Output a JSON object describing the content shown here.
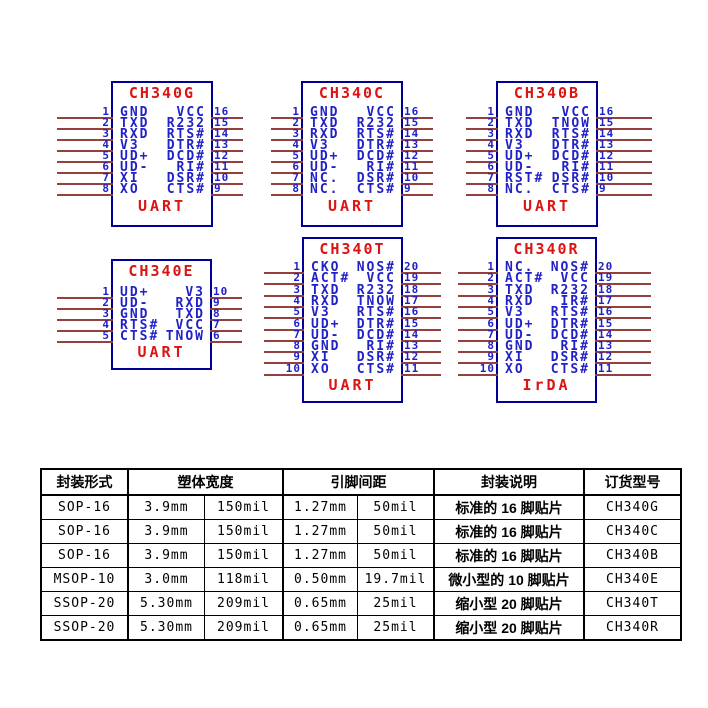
{
  "chips": [
    {
      "title": "CH340G",
      "function_label": "UART",
      "left_pins": [
        {
          "num": "1",
          "label": "GND"
        },
        {
          "num": "2",
          "label": "TXD"
        },
        {
          "num": "3",
          "label": "RXD"
        },
        {
          "num": "4",
          "label": "V3"
        },
        {
          "num": "5",
          "label": "UD+"
        },
        {
          "num": "6",
          "label": "UD-"
        },
        {
          "num": "7",
          "label": "XI"
        },
        {
          "num": "8",
          "label": "XO"
        }
      ],
      "right_pins": [
        {
          "num": "16",
          "label": "VCC"
        },
        {
          "num": "15",
          "label": "R232"
        },
        {
          "num": "14",
          "label": "RTS#"
        },
        {
          "num": "13",
          "label": "DTR#"
        },
        {
          "num": "12",
          "label": "DCD#"
        },
        {
          "num": "11",
          "label": "RI#"
        },
        {
          "num": "10",
          "label": "DSR#"
        },
        {
          "num": "9",
          "label": "CTS#"
        }
      ]
    },
    {
      "title": "CH340C",
      "function_label": "UART",
      "left_pins": [
        {
          "num": "1",
          "label": "GND"
        },
        {
          "num": "2",
          "label": "TXD"
        },
        {
          "num": "3",
          "label": "RXD"
        },
        {
          "num": "4",
          "label": "V3"
        },
        {
          "num": "5",
          "label": "UD+"
        },
        {
          "num": "6",
          "label": "UD-"
        },
        {
          "num": "7",
          "label": "NC."
        },
        {
          "num": "8",
          "label": "NC."
        }
      ],
      "right_pins": [
        {
          "num": "16",
          "label": "VCC"
        },
        {
          "num": "15",
          "label": "R232"
        },
        {
          "num": "14",
          "label": "RTS#"
        },
        {
          "num": "13",
          "label": "DTR#"
        },
        {
          "num": "12",
          "label": "DCD#"
        },
        {
          "num": "11",
          "label": "RI#"
        },
        {
          "num": "10",
          "label": "DSR#"
        },
        {
          "num": "9",
          "label": "CTS#"
        }
      ]
    },
    {
      "title": "CH340B",
      "function_label": "UART",
      "left_pins": [
        {
          "num": "1",
          "label": "GND"
        },
        {
          "num": "2",
          "label": "TXD"
        },
        {
          "num": "3",
          "label": "RXD"
        },
        {
          "num": "4",
          "label": "V3"
        },
        {
          "num": "5",
          "label": "UD+"
        },
        {
          "num": "6",
          "label": "UD-"
        },
        {
          "num": "7",
          "label": "RST#"
        },
        {
          "num": "8",
          "label": "NC."
        }
      ],
      "right_pins": [
        {
          "num": "16",
          "label": "VCC"
        },
        {
          "num": "15",
          "label": "TNOW"
        },
        {
          "num": "14",
          "label": "RTS#"
        },
        {
          "num": "13",
          "label": "DTR#"
        },
        {
          "num": "12",
          "label": "DCD#"
        },
        {
          "num": "11",
          "label": "RI#"
        },
        {
          "num": "10",
          "label": "DSR#"
        },
        {
          "num": "9",
          "label": "CTS#"
        }
      ]
    },
    {
      "title": "CH340E",
      "function_label": "UART",
      "left_pins": [
        {
          "num": "1",
          "label": "UD+"
        },
        {
          "num": "2",
          "label": "UD-"
        },
        {
          "num": "3",
          "label": "GND"
        },
        {
          "num": "4",
          "label": "RTS#"
        },
        {
          "num": "5",
          "label": "CTS#"
        }
      ],
      "right_pins": [
        {
          "num": "10",
          "label": "V3"
        },
        {
          "num": "9",
          "label": "RXD"
        },
        {
          "num": "8",
          "label": "TXD"
        },
        {
          "num": "7",
          "label": "VCC"
        },
        {
          "num": "6",
          "label": "TNOW"
        }
      ]
    },
    {
      "title": "CH340T",
      "function_label": "UART",
      "left_pins": [
        {
          "num": "1",
          "label": "CKO"
        },
        {
          "num": "2",
          "label": "ACT#"
        },
        {
          "num": "3",
          "label": "TXD"
        },
        {
          "num": "4",
          "label": "RXD"
        },
        {
          "num": "5",
          "label": "V3"
        },
        {
          "num": "6",
          "label": "UD+"
        },
        {
          "num": "7",
          "label": "UD-"
        },
        {
          "num": "8",
          "label": "GND"
        },
        {
          "num": "9",
          "label": "XI"
        },
        {
          "num": "10",
          "label": "XO"
        }
      ],
      "right_pins": [
        {
          "num": "20",
          "label": "NOS#"
        },
        {
          "num": "19",
          "label": "VCC"
        },
        {
          "num": "18",
          "label": "R232"
        },
        {
          "num": "17",
          "label": "TNOW"
        },
        {
          "num": "16",
          "label": "RTS#"
        },
        {
          "num": "15",
          "label": "DTR#"
        },
        {
          "num": "14",
          "label": "DCD#"
        },
        {
          "num": "13",
          "label": "RI#"
        },
        {
          "num": "12",
          "label": "DSR#"
        },
        {
          "num": "11",
          "label": "CTS#"
        }
      ]
    },
    {
      "title": "CH340R",
      "function_label": "IrDA",
      "left_pins": [
        {
          "num": "1",
          "label": "NC."
        },
        {
          "num": "2",
          "label": "ACT#"
        },
        {
          "num": "3",
          "label": "TXD"
        },
        {
          "num": "4",
          "label": "RXD"
        },
        {
          "num": "5",
          "label": "V3"
        },
        {
          "num": "6",
          "label": "UD+"
        },
        {
          "num": "7",
          "label": "UD-"
        },
        {
          "num": "8",
          "label": "GND"
        },
        {
          "num": "9",
          "label": "XI"
        },
        {
          "num": "10",
          "label": "XO"
        }
      ],
      "right_pins": [
        {
          "num": "20",
          "label": "NOS#"
        },
        {
          "num": "19",
          "label": "VCC"
        },
        {
          "num": "18",
          "label": "R232"
        },
        {
          "num": "17",
          "label": "IR#"
        },
        {
          "num": "16",
          "label": "RTS#"
        },
        {
          "num": "15",
          "label": "DTR#"
        },
        {
          "num": "14",
          "label": "DCD#"
        },
        {
          "num": "13",
          "label": "RI#"
        },
        {
          "num": "12",
          "label": "DSR#"
        },
        {
          "num": "11",
          "label": "CTS#"
        }
      ]
    }
  ],
  "table": {
    "headers": [
      "封装形式",
      "塑体宽度",
      "引脚间距",
      "封装说明",
      "订货型号"
    ],
    "rows": [
      [
        "SOP-16",
        "3.9mm",
        "150mil",
        "1.27mm",
        "50mil",
        "标准的 16 脚贴片",
        "CH340G"
      ],
      [
        "SOP-16",
        "3.9mm",
        "150mil",
        "1.27mm",
        "50mil",
        "标准的 16 脚贴片",
        "CH340C"
      ],
      [
        "SOP-16",
        "3.9mm",
        "150mil",
        "1.27mm",
        "50mil",
        "标准的 16 脚贴片",
        "CH340B"
      ],
      [
        "MSOP-10",
        "3.0mm",
        "118mil",
        "0.50mm",
        "19.7mil",
        "微小型的 10 脚贴片",
        "CH340E"
      ],
      [
        "SSOP-20",
        "5.30mm",
        "209mil",
        "0.65mm",
        "25mil",
        "缩小型 20 脚贴片",
        "CH340T"
      ],
      [
        "SSOP-20",
        "5.30mm",
        "209mil",
        "0.65mm",
        "25mil",
        "缩小型 20 脚贴片",
        "CH340R"
      ]
    ]
  },
  "colors": {
    "pin_text_blue": "#2121c8",
    "chip_border_navy": "#000096",
    "label_red": "#dc1414",
    "wire_maroon": "#94403f",
    "table_border_black": "#000000",
    "background": "#ffffff"
  }
}
